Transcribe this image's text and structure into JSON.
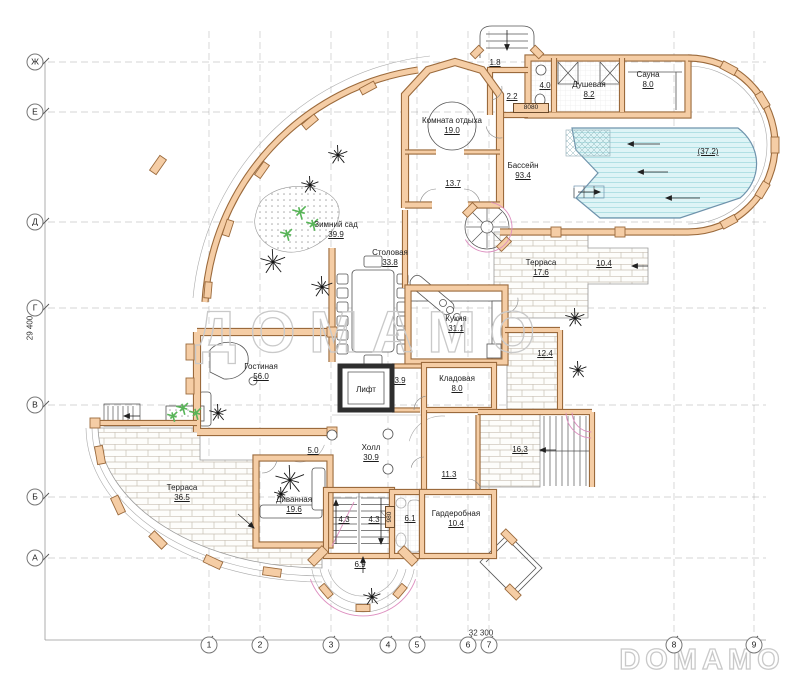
{
  "watermarks": {
    "center": "ДОМАМО",
    "corner": "DOMAMO"
  },
  "dimensions": {
    "left_total": "29 400",
    "bottom_total": "32 300"
  },
  "tags": {
    "door_top": "8080",
    "door_side": "980"
  },
  "grid": {
    "rows": [
      "Ж",
      "Е",
      "Д",
      "Г",
      "В",
      "Б",
      "А"
    ],
    "cols": [
      "1",
      "2",
      "3",
      "4",
      "5",
      "6",
      "7",
      "8",
      "9"
    ]
  },
  "rooms": [
    {
      "id": "komnata-otdyha",
      "name": "Комната отдыха",
      "area": "19.0"
    },
    {
      "id": "r13-7",
      "name": "",
      "area": "13.7"
    },
    {
      "id": "bassein",
      "name": "Бассейн",
      "area": "93.4"
    },
    {
      "id": "pool-water",
      "name": "",
      "area": "(37.2)"
    },
    {
      "id": "r1-8",
      "name": "",
      "area": "1.8"
    },
    {
      "id": "r2-2",
      "name": "",
      "area": "2.2"
    },
    {
      "id": "r4-0",
      "name": "",
      "area": "4.0"
    },
    {
      "id": "dushevaya",
      "name": "Душевая",
      "area": "8.2"
    },
    {
      "id": "sauna",
      "name": "Сауна",
      "area": "8.0"
    },
    {
      "id": "zimniy-sad",
      "name": "Зимний сад",
      "area": "39.9"
    },
    {
      "id": "stolovaya",
      "name": "Столовая",
      "area": "33.8"
    },
    {
      "id": "terrasa-17",
      "name": "Терраса",
      "area": "17.6"
    },
    {
      "id": "r10-4",
      "name": "",
      "area": "10.4"
    },
    {
      "id": "kuhnya",
      "name": "Кухня",
      "area": "31.1"
    },
    {
      "id": "r12-4",
      "name": "",
      "area": "12.4"
    },
    {
      "id": "gostinaya",
      "name": "Гостиная",
      "area": "56.0"
    },
    {
      "id": "lift",
      "name": "Лифт",
      "area": ""
    },
    {
      "id": "r3-9",
      "name": "",
      "area": "3.9"
    },
    {
      "id": "kladovaya",
      "name": "Кладовая",
      "area": "8.0"
    },
    {
      "id": "holl",
      "name": "Холл",
      "area": "30.9"
    },
    {
      "id": "r5-0",
      "name": "",
      "area": "5.0"
    },
    {
      "id": "r16-3",
      "name": "",
      "area": "16.3"
    },
    {
      "id": "r11-3",
      "name": "",
      "area": "11.3"
    },
    {
      "id": "terrasa-36",
      "name": "Терраса",
      "area": "36.5"
    },
    {
      "id": "divannaya",
      "name": "Диванная",
      "area": "19.6"
    },
    {
      "id": "r4-3a",
      "name": "",
      "area": "4.3"
    },
    {
      "id": "r4-3b",
      "name": "",
      "area": "4.3"
    },
    {
      "id": "r6-1",
      "name": "",
      "area": "6.1"
    },
    {
      "id": "garderobnaya",
      "name": "Гардеробная",
      "area": "10.4"
    },
    {
      "id": "r6-9",
      "name": "",
      "area": "6.9"
    }
  ]
}
